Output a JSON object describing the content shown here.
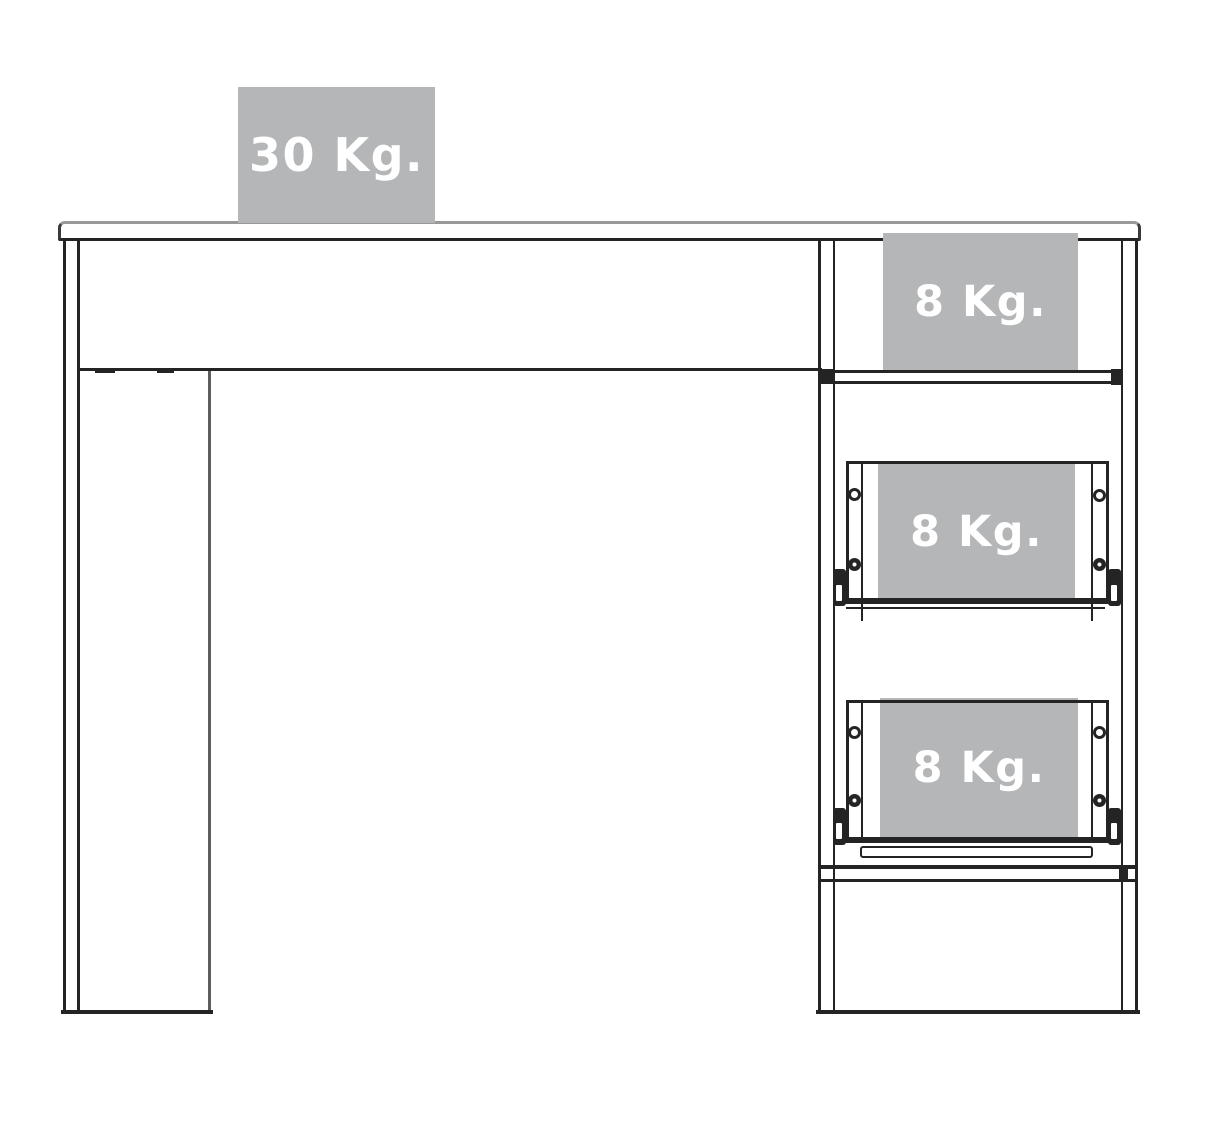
{
  "diagram": {
    "name": "Desk maximum load capacity diagram",
    "units": "Kg.",
    "loads": {
      "desktop": "30 Kg.",
      "open_shelf": "8 Kg.",
      "upper_drawer": "8 Kg.",
      "lower_drawer": "8 Kg."
    },
    "colors": {
      "badge_background": "#b4b6b8",
      "badge_text": "#ffffff",
      "outline_dark": "#242424",
      "outline_light": "#97999b",
      "background": "#ffffff"
    }
  }
}
